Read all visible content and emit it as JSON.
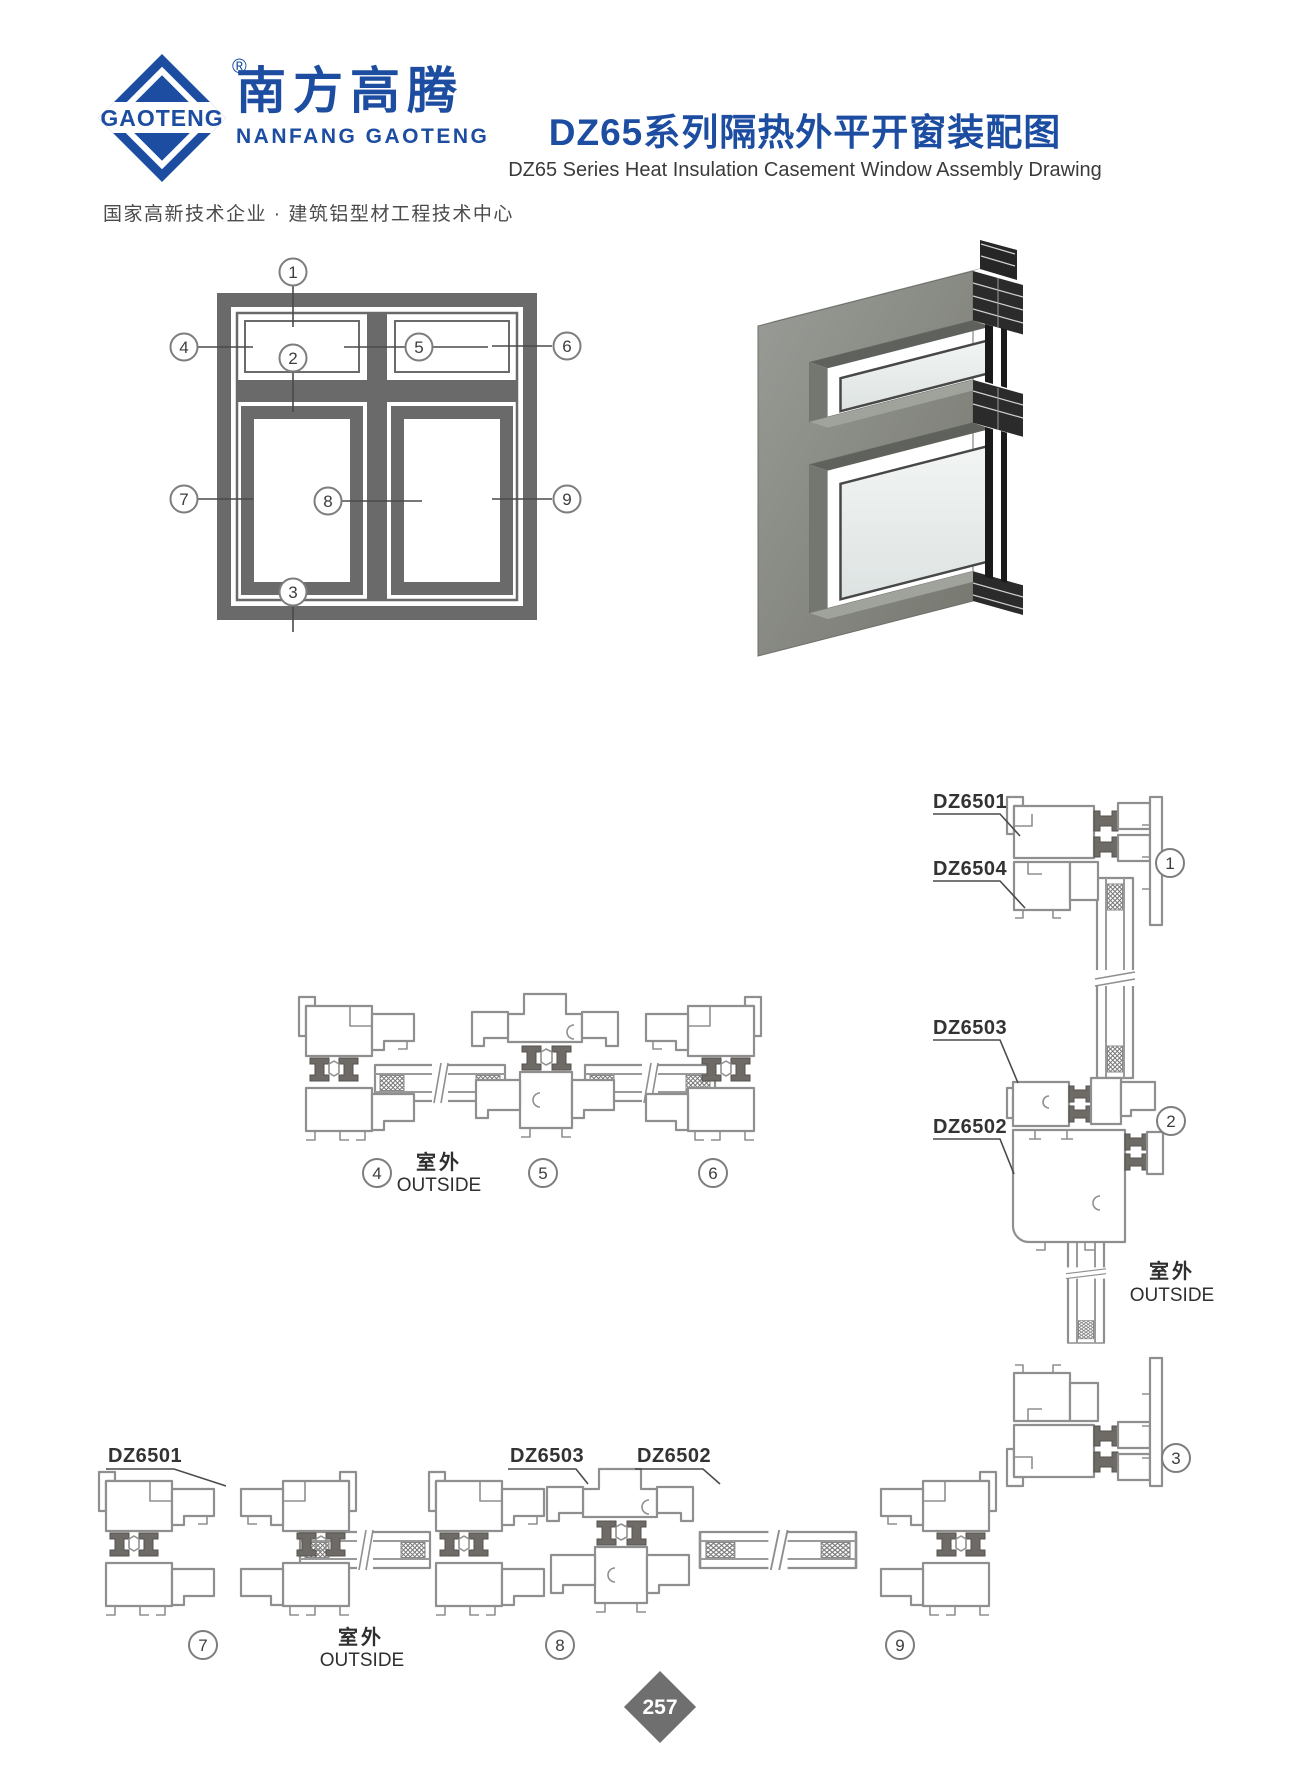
{
  "header": {
    "brand_mark": "GAOTENG",
    "reg_mark": "®",
    "brand_cn": "南方高腾",
    "brand_latin": "NANFANG GAOTENG",
    "tagline": "国家高新技术企业 · 建筑铝型材工程技术中心",
    "title_cn": "DZ65系列隔热外平开窗装配图",
    "title_en": "DZ65 Series Heat Insulation Casement Window Assembly Drawing"
  },
  "labels": {
    "outside_cn": "室外",
    "outside_en": "OUTSIDE",
    "dz6501": "DZ6501",
    "dz6502": "DZ6502",
    "dz6503": "DZ6503",
    "dz6504": "DZ6504"
  },
  "callouts": {
    "c1": "1",
    "c2": "2",
    "c3": "3",
    "c4": "4",
    "c5": "5",
    "c6": "6",
    "c7": "7",
    "c8": "8",
    "c9": "9"
  },
  "page": {
    "number": "257"
  },
  "colors": {
    "brand_blue": "#1c4da1",
    "heading_text": "#3a3a3a",
    "elevation_gray": "#6a6a6a",
    "drawing_line": "#8f8f8f",
    "thermal_break": "#6e6a66",
    "leader": "#4a4a4a",
    "render_body": "#84867f",
    "render_section": "#262626",
    "page_badge": "#6f6f6f"
  }
}
